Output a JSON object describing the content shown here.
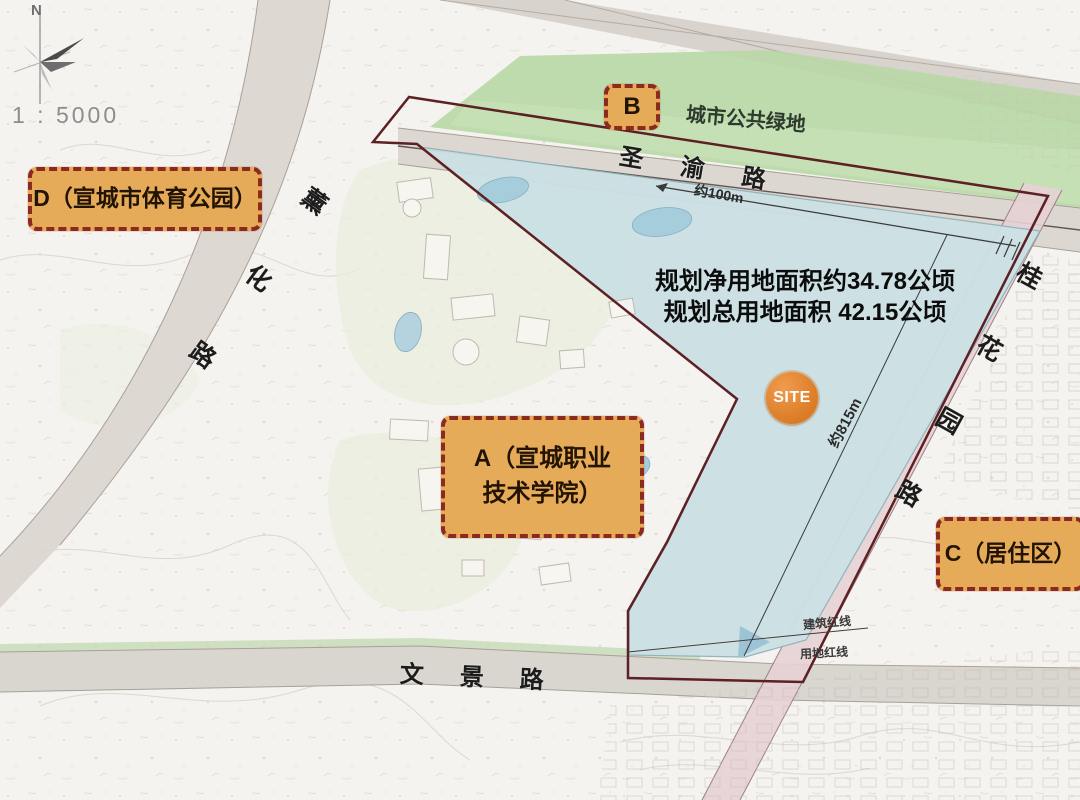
{
  "compass": {
    "north": "N"
  },
  "scale": "1 : 5000",
  "zones": {
    "d": {
      "label": "D（宣城市体育公园）"
    },
    "b": {
      "label": "B"
    },
    "a": {
      "line1": "A（宣城职业",
      "line2": "技术学院）"
    },
    "c": {
      "label": "C（居住区）"
    },
    "green": {
      "label": "城市公共绿地"
    }
  },
  "roads": {
    "top": "圣渝路",
    "left": "薰化路",
    "right": "桂花园路",
    "bottom": "文景路"
  },
  "site": {
    "marker": "SITE",
    "stats_line1": "规划净用地面积约34.78公顷",
    "stats_line2": "规划总用地面积 42.15公顷"
  },
  "dimensions": {
    "frontage": "约100m",
    "depth": "约815m"
  },
  "redlines": {
    "building": "建筑红线",
    "landuse": "用地红线"
  },
  "colors": {
    "label_bg": "#e5ab59",
    "label_border": "#8b2a1d",
    "site_orange": "#dd7e28",
    "boundary": "#5d2024",
    "water": "#cbe0e4",
    "green": "#b8d8a6",
    "text_dark": "#1c1c1c"
  }
}
